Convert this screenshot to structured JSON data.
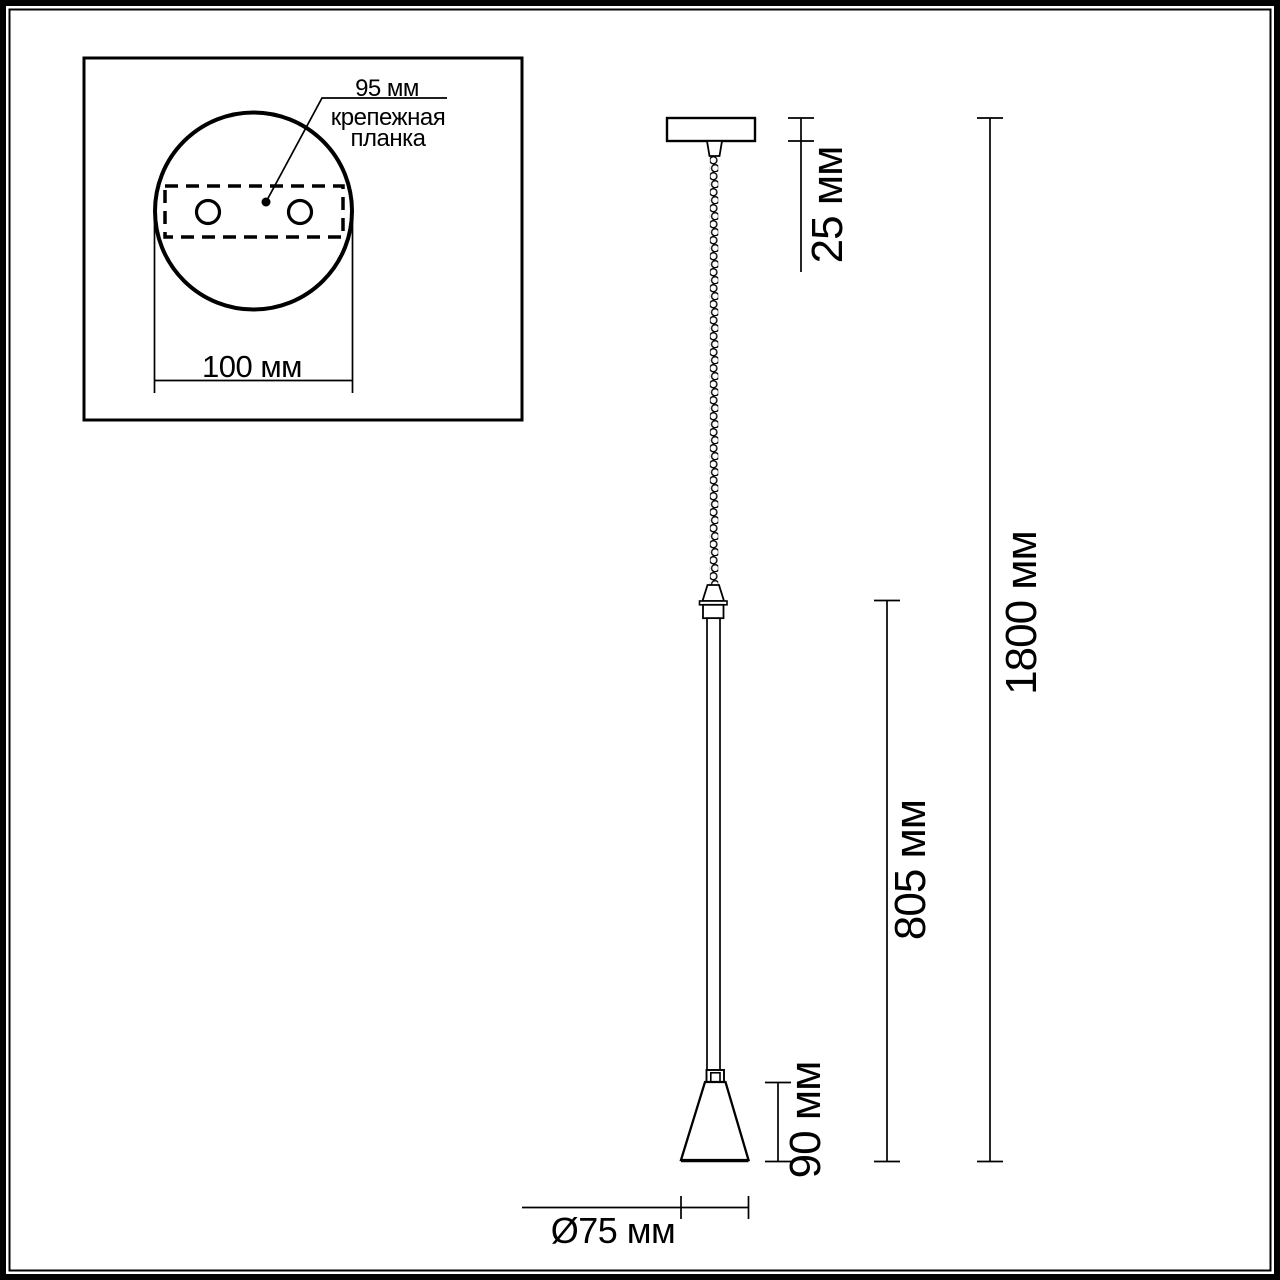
{
  "diagram": {
    "type": "technical-dimension-drawing",
    "subject": "pendant-lamp",
    "colors": {
      "line": "#000000",
      "background": "#ffffff"
    },
    "inset": {
      "spacing_label": "95 мм",
      "caption_line1": "крепежная",
      "caption_line2": "планка",
      "diameter_label": "100 мм"
    },
    "dimensions": {
      "canopy_height": "25 мм",
      "overall_height": "1800 мм",
      "suspension_length": "805 мм",
      "shade_height": "90 мм",
      "shade_diameter": "Ø75 мм"
    }
  }
}
